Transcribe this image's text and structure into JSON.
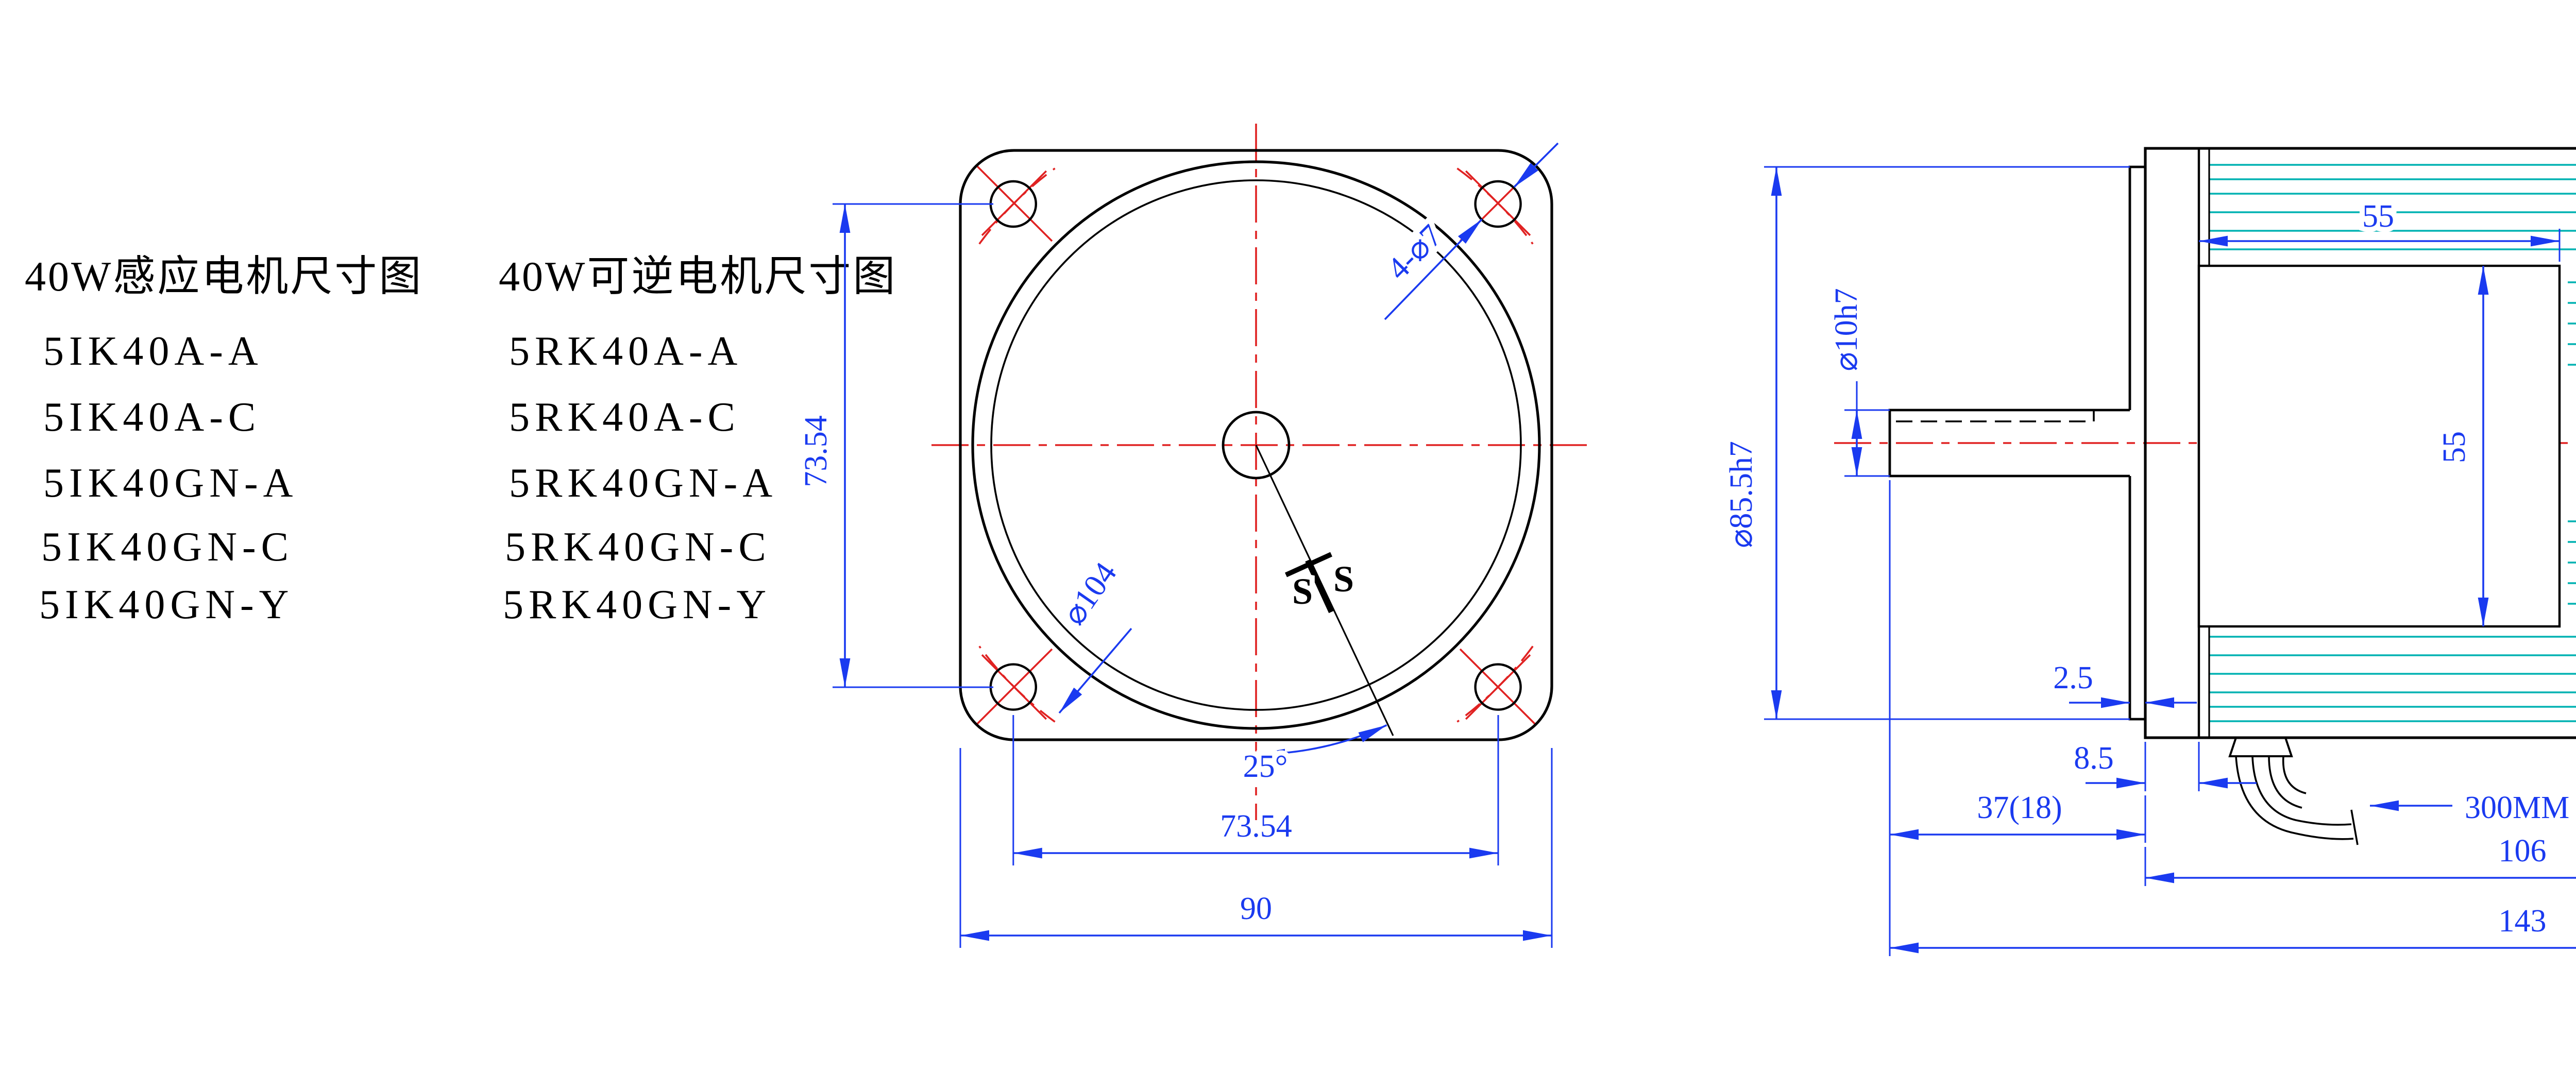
{
  "titles": {
    "left": "40W感应电机尺寸图",
    "right": "40W可逆电机尺寸图"
  },
  "left_models": [
    "5IK40A-A",
    "5IK40A-C",
    "5IK40GN-A",
    "5IK40GN-C",
    "5IK40GN-Y"
  ],
  "right_models": [
    "5RK40A-A",
    "5RK40A-C",
    "5RK40GN-A",
    "5RK40GN-C",
    "5RK40GN-Y"
  ],
  "front_view": {
    "holes_label": "4-⌀7",
    "bolt_circle_dia": "⌀104",
    "angle": "25°",
    "section_mark_left": "S",
    "section_mark_right": "S",
    "hole_spacing_vertical": "73.54",
    "hole_spacing_horizontal": "73.54",
    "frame_width": "90"
  },
  "side_view": {
    "stator_width": "55",
    "stator_height": "55",
    "spigot_dia": "⌀85.5h7",
    "shaft_dia": "⌀10h7",
    "rear_dia": "⌀85.4",
    "spigot_depth": "2.5",
    "boss_depth": "8.5",
    "shaft_length": "37(18)",
    "cable_length": "300MM",
    "rear_cap_length": "13",
    "body_length": "106",
    "total_length": "143"
  },
  "colors": {
    "dimension_blue": "#1a3af0",
    "centerline_red": "#e02222",
    "fin_teal": "#00b2b2",
    "line_black": "#000000",
    "background": "#ffffff"
  }
}
